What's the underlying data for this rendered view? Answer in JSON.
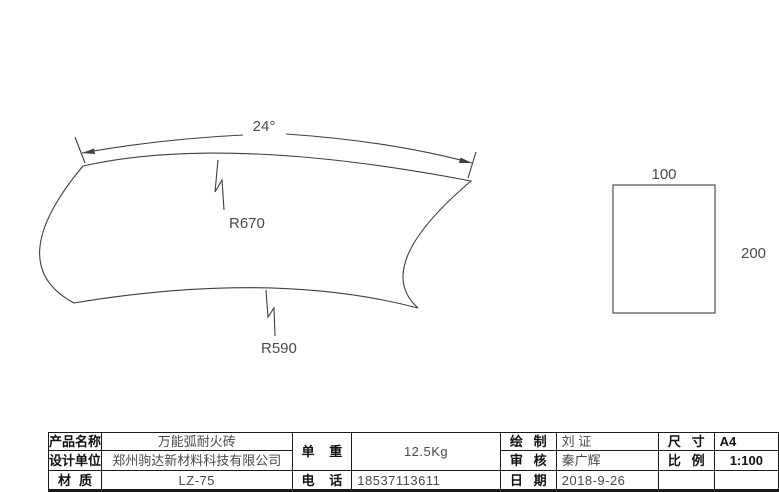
{
  "drawing": {
    "angle_label": "24°",
    "outer_radius_label": "R670",
    "inner_radius_label": "R590",
    "side_view": {
      "width_label": "100",
      "height_label": "200"
    }
  },
  "title_block": {
    "product_name_label": "产品名称",
    "product_name": "万能弧耐火砖",
    "design_unit_label": "设计单位",
    "design_unit": "郑州驹达新材料科技有限公司",
    "material_label": "材 质",
    "material": "LZ-75",
    "unit_weight_label": "单 重",
    "unit_weight": "12.5Kg",
    "phone_label": "电 话",
    "phone": "18537113611",
    "drawn_label": "绘 制",
    "drawn_by": "刘 证",
    "checked_label": "审 核",
    "checked_by": "秦广辉",
    "date_label": "日 期",
    "date": "2018-9-26",
    "size_label": "尺 寸",
    "size": "A4",
    "scale_label": "比 例",
    "scale": "1:100"
  },
  "colors": {
    "line": "#3f3f3f",
    "dim_text": "#4a4a4a",
    "table_border": "#1a1a1a",
    "background": "#ffffff"
  }
}
